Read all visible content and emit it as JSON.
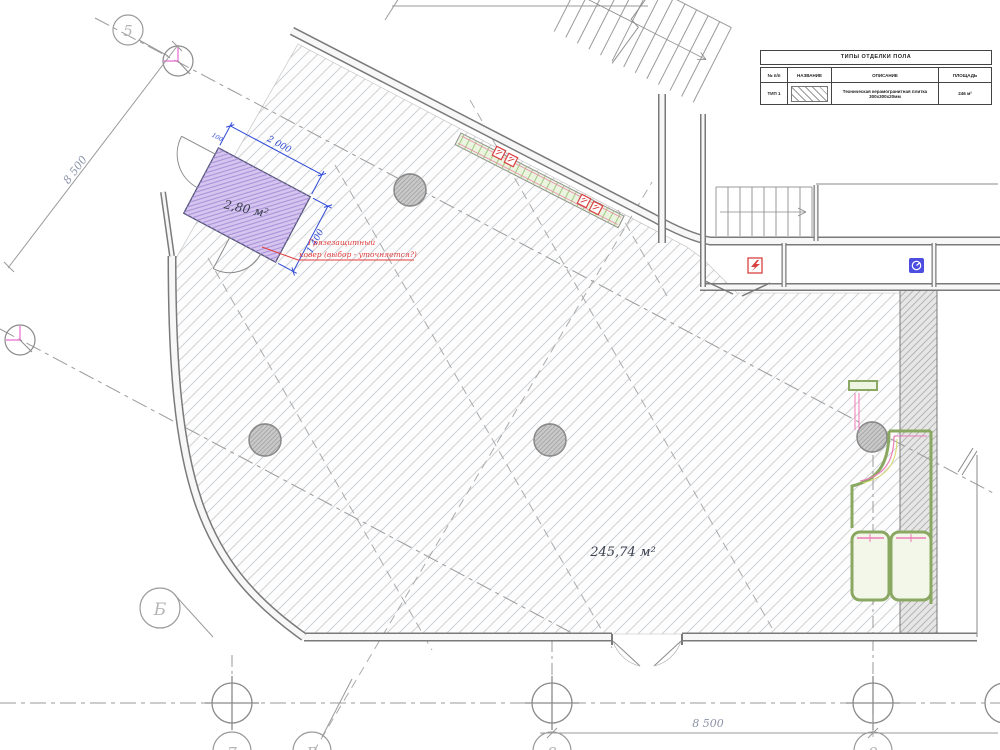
{
  "plan": {
    "area_main": "245,74 м²",
    "area_vest": "2,80 м²",
    "dim_a": "2 000",
    "dim_b": "1 400",
    "dim_c": "100",
    "dim_left": "8 500",
    "dim_bottom": "8 500",
    "note1": "Грязезащитный",
    "note2": "ковер (выбор - уточняется?)"
  },
  "grid": {
    "b5": "5",
    "bb": "Б",
    "b7": "7",
    "bv": "В",
    "b8": "8",
    "b9": "9"
  },
  "table": {
    "title": "ТИПЫ ОТДЕЛКИ ПОЛА",
    "col_num": "№ п/п",
    "col_name": "НАЗВАНИЕ",
    "col_desc": "ОПИСАНИЕ",
    "col_area": "ПЛОЩАДЬ",
    "row_num": "ТИП 1",
    "row_desc": "Техническая керамогранитная плитка 300х300х20мм",
    "row_area": "246 м²"
  },
  "colors": {
    "hatch": "#cfd2d6",
    "wall": "#7a7a7a",
    "axis": "#9a9a9a",
    "dim_blue": "#2f4bd8",
    "note_red": "#e23b3b",
    "vestibule_fill": "#d5c5f0",
    "strip_green": "#eaf4de",
    "wc_green": "#8aa862",
    "pink": "#ef7ab8",
    "symbol_red": "#d84040",
    "symbol_blue": "#4d4de0"
  }
}
